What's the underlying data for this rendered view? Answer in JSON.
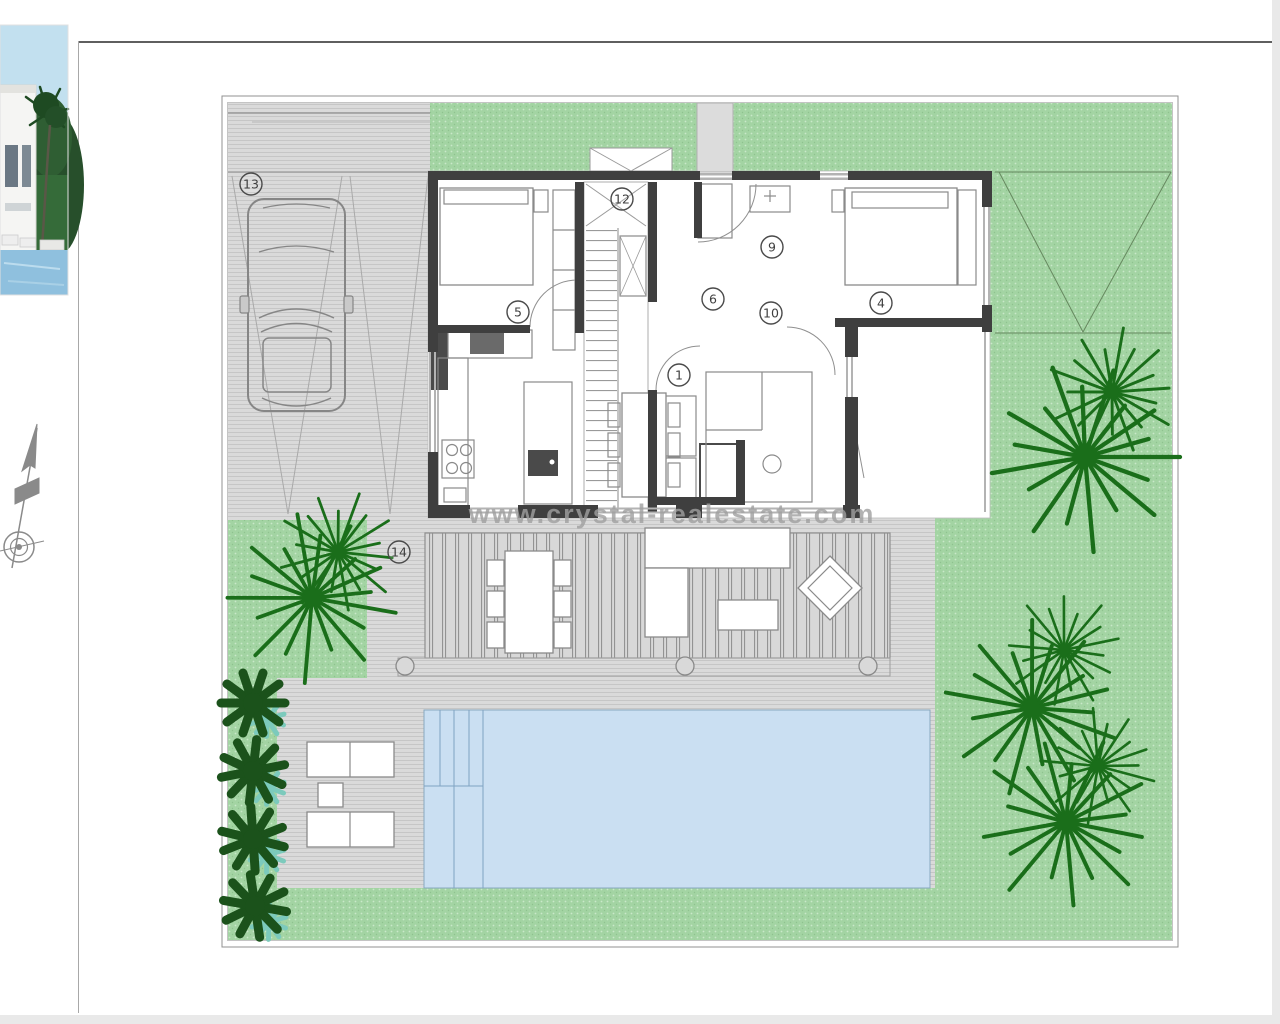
{
  "page": {
    "background": "#ffffff",
    "chrome_gray": "#e9e9e9",
    "frame_line": "#5f5f5f"
  },
  "margin_items": {
    "photo_thumbnail_icon": "villa-pool-photo",
    "compass_icon": "north-arrow-compass"
  },
  "plan": {
    "watermark": "www.crystal-realestate.com",
    "room_markers": [
      "1",
      "4",
      "5",
      "6",
      "9",
      "10",
      "12",
      "13",
      "14"
    ],
    "colors": {
      "grass": "#a3d4a3",
      "grass_dot": "#c9e8c9",
      "paving": "#dadada",
      "paving_line": "#c6c6c6",
      "deck_plank_line": "#939393",
      "pool": "#cadff2",
      "pool_step_line": "#7fa3c2",
      "wall": "#3f3f3f",
      "palm": "#1a6e1a",
      "bush": "#1b521b",
      "bush_accent": "#7ccabc",
      "marker": "#4a4a4a",
      "watermark_color": "#a0a0a0"
    }
  }
}
